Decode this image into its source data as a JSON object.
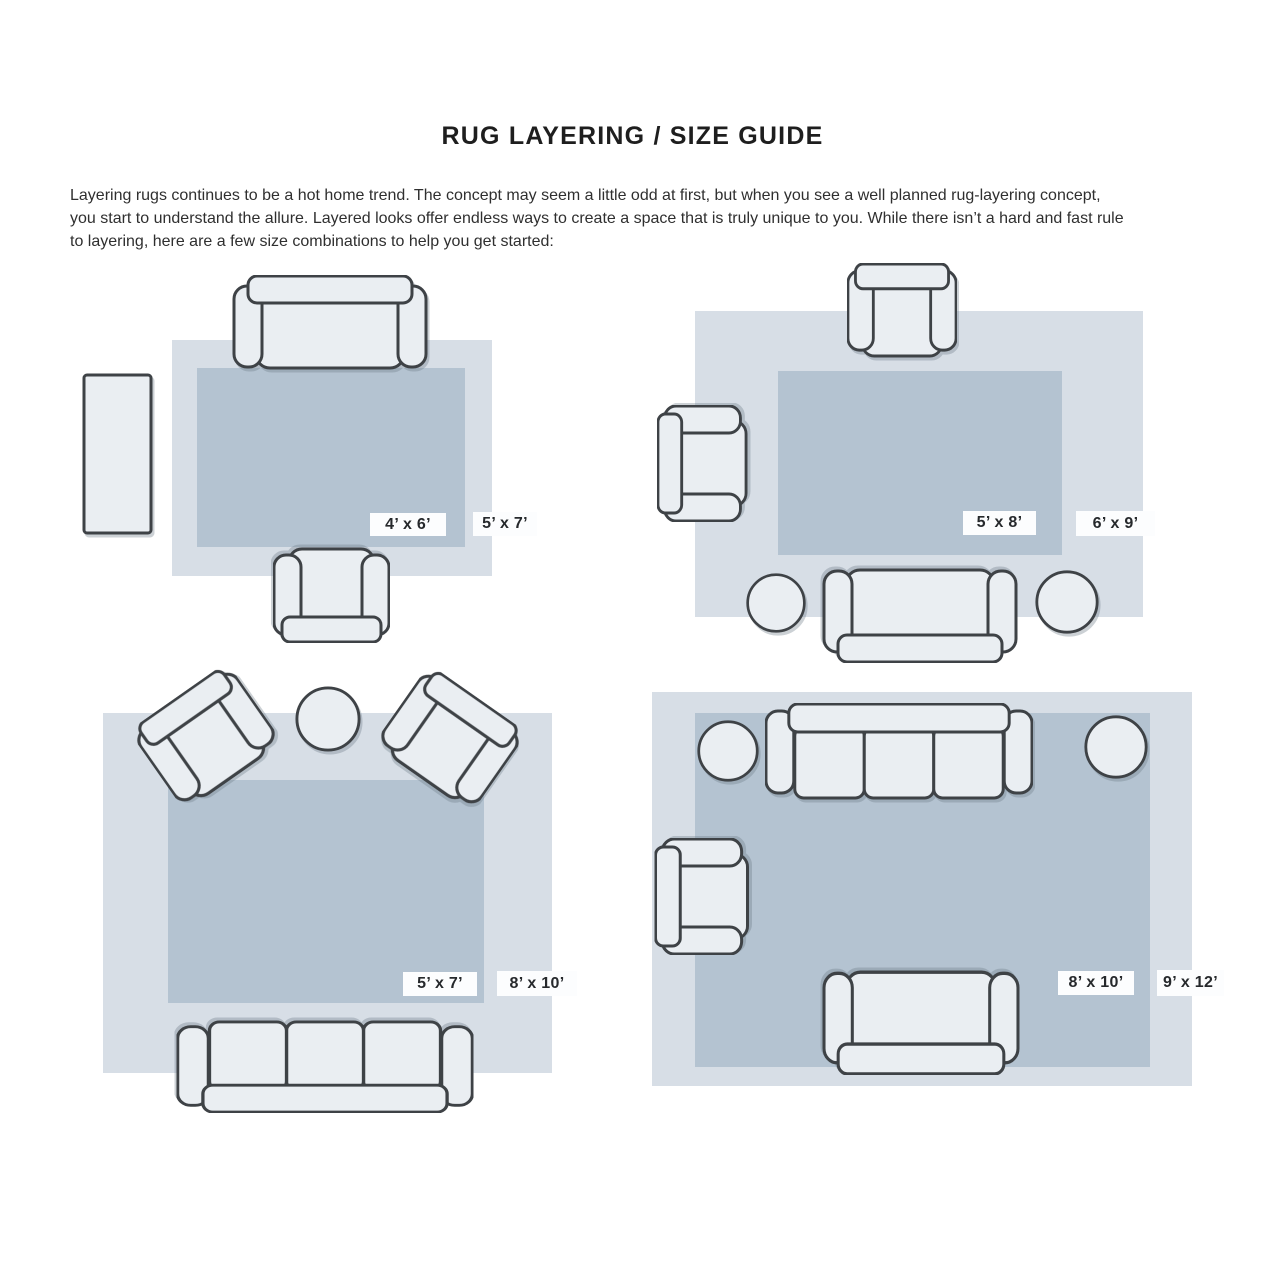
{
  "page": {
    "title": "RUG LAYERING / SIZE GUIDE",
    "intro_lines": [
      "Layering rugs continues to be a hot home trend. The concept may seem a little odd at first, but when you see a well planned rug-layering concept,",
      "you start to understand the allure. Layered looks offer endless ways to create a space that is truly unique to you. While there isn’t a hard and fast rule",
      "to layering, here are a few size combinations to help you get started:"
    ]
  },
  "colors": {
    "rug_outer": "#d7dee6",
    "rug_inner": "#b4c3d1",
    "furniture_fill": "#eaeef2",
    "furniture_stroke": "#3e4246",
    "badge_bg": "#fcfdfe",
    "badge_text": "#26292c",
    "title_text": "#1e1e1e",
    "body_text": "#2f2f2f"
  },
  "layouts": [
    {
      "name": "top-left",
      "inner_label": "4’ x 6’",
      "outer_label": "5’ x 7’"
    },
    {
      "name": "top-right",
      "inner_label": "5’ x 8’",
      "outer_label": "6’ x 9’"
    },
    {
      "name": "bottom-left",
      "inner_label": "5’ x 7’",
      "outer_label": "8’ x 10’"
    },
    {
      "name": "bottom-right",
      "inner_label": "8’ x 10’",
      "outer_label": "9’ x 12’"
    }
  ]
}
